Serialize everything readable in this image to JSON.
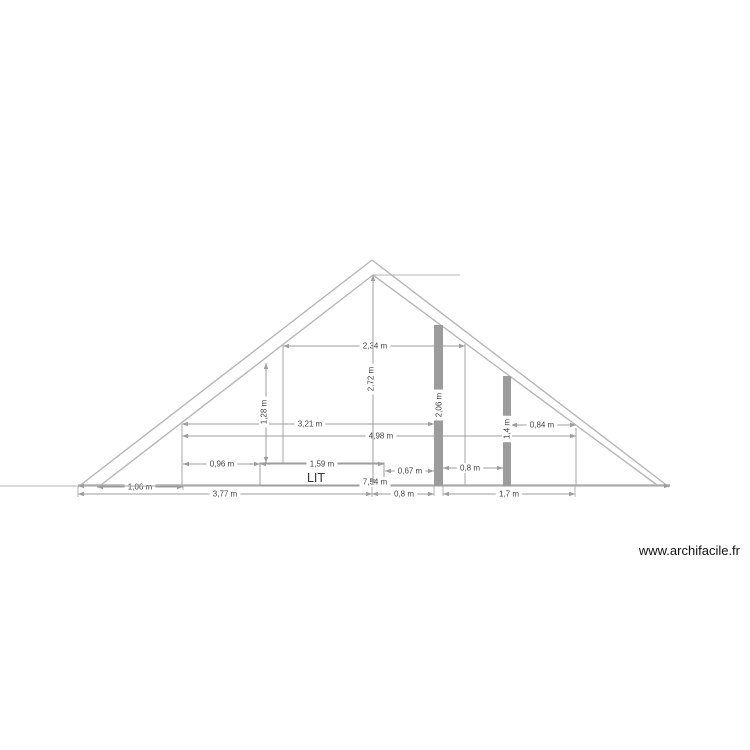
{
  "watermark": "www.archifacile.fr",
  "colors": {
    "background": "#ffffff",
    "structure": "#b6b6b6",
    "dim_line": "#9d9d9d",
    "dim_text": "#434343",
    "post_fill": "#9c9c9c",
    "room_text": "#353535",
    "watermark_text": "#111111"
  },
  "drawing": {
    "structure_lines": [
      {
        "name": "roof-outer-left-line",
        "x1": 78,
        "y1": 487,
        "x2": 372,
        "y2": 260,
        "w": 1.4
      },
      {
        "name": "roof-outer-right-line",
        "x1": 372,
        "y1": 260,
        "x2": 669,
        "y2": 487,
        "w": 1.4
      },
      {
        "name": "roof-inner-left-line",
        "x1": 101,
        "y1": 485,
        "x2": 373,
        "y2": 275,
        "w": 1.4
      },
      {
        "name": "roof-inner-right-line",
        "x1": 373,
        "y1": 275,
        "x2": 657,
        "y2": 485,
        "w": 1.4
      },
      {
        "name": "ridge-guide-line",
        "x1": 373,
        "y1": 275,
        "x2": 460,
        "y2": 275,
        "w": 1
      },
      {
        "name": "left-guide-line",
        "x1": 0,
        "y1": 486,
        "x2": 80,
        "y2": 486,
        "w": 1
      },
      {
        "name": "floor-line",
        "x1": 78,
        "y1": 485,
        "x2": 670,
        "y2": 485,
        "w": 1.6
      },
      {
        "name": "knee-wall-left",
        "x1": 182,
        "y1": 424,
        "x2": 182,
        "y2": 485,
        "w": 1.2
      },
      {
        "name": "knee-wall-right",
        "x1": 576,
        "y1": 428,
        "x2": 576,
        "y2": 485,
        "w": 1.2
      },
      {
        "name": "partition-wall-left",
        "x1": 283,
        "y1": 344,
        "x2": 283,
        "y2": 485,
        "w": 1.2
      },
      {
        "name": "partition-wall-right",
        "x1": 465,
        "y1": 344,
        "x2": 465,
        "y2": 485,
        "w": 1.2
      },
      {
        "name": "extension-tick-left",
        "x1": 78,
        "y1": 486,
        "x2": 78,
        "y2": 497,
        "w": 1
      },
      {
        "name": "extension-tick-eave",
        "x1": 183,
        "y1": 485,
        "x2": 183,
        "y2": 490,
        "w": 1
      },
      {
        "name": "extension-tick-center",
        "x1": 372,
        "y1": 485,
        "x2": 372,
        "y2": 497,
        "w": 1
      },
      {
        "name": "extension-tick-post1-left",
        "x1": 434,
        "y1": 486,
        "x2": 434,
        "y2": 496,
        "w": 1
      },
      {
        "name": "extension-tick-post1-right",
        "x1": 443,
        "y1": 486,
        "x2": 443,
        "y2": 496,
        "w": 1
      },
      {
        "name": "extension-tick-right",
        "x1": 575,
        "y1": 486,
        "x2": 575,
        "y2": 497,
        "w": 1
      }
    ],
    "posts": [
      {
        "name": "post-tall",
        "x": 434,
        "y": 325,
        "w": 9,
        "h": 161,
        "label": "2,06 m",
        "lx": 439,
        "ly": 405
      },
      {
        "name": "post-short",
        "x": 503,
        "y": 376,
        "w": 8,
        "h": 110,
        "label": "1,4 m",
        "lx": 507,
        "ly": 429
      }
    ],
    "bed": {
      "name": "bed",
      "x": 260,
      "y": 463,
      "w": 124,
      "h": 22,
      "label": "LIT",
      "lx": 316,
      "ly": 478
    },
    "h_dims": [
      {
        "label": "2,34 m",
        "x1": 283,
        "x2": 465,
        "y": 346,
        "tx": 375
      },
      {
        "label": "3,21 m",
        "x1": 182,
        "x2": 434,
        "y": 424,
        "tx": 310
      },
      {
        "label": "4,98 m",
        "x1": 182,
        "x2": 576,
        "y": 436,
        "tx": 381
      },
      {
        "label": "0,84 m",
        "x1": 511,
        "x2": 576,
        "y": 425,
        "tx": 542
      },
      {
        "label": "0,96 m",
        "x1": 183,
        "x2": 260,
        "y": 464,
        "tx": 222
      },
      {
        "label": "1,59 m",
        "x1": 260,
        "x2": 384,
        "y": 464,
        "tx": 322
      },
      {
        "label": "0,67 m",
        "x1": 385,
        "x2": 434,
        "y": 471,
        "tx": 410
      },
      {
        "label": "0,8 m",
        "x1": 443,
        "x2": 503,
        "y": 468,
        "tx": 470
      },
      {
        "label": "1,06 m",
        "x1": 97,
        "x2": 183,
        "y": 487,
        "tx": 140
      },
      {
        "label": "7,54 m",
        "x1": 78,
        "x2": 670,
        "y": 486,
        "tx": 375,
        "ty": 482
      },
      {
        "label": "3,77 m",
        "x1": 78,
        "x2": 372,
        "y": 494,
        "tx": 225
      },
      {
        "label": "0,8 m",
        "x1": 372,
        "x2": 434,
        "y": 494,
        "tx": 404
      },
      {
        "label": "1,7 m",
        "x1": 443,
        "x2": 575,
        "y": 494,
        "tx": 509
      }
    ],
    "v_dims": [
      {
        "label": "2,72 m",
        "x": 373,
        "y1": 275,
        "y2": 485,
        "tx": 371,
        "ty": 379
      },
      {
        "label": "1,28 m",
        "x": 266,
        "y1": 363,
        "y2": 463,
        "tx": 264,
        "ty": 412
      }
    ]
  }
}
